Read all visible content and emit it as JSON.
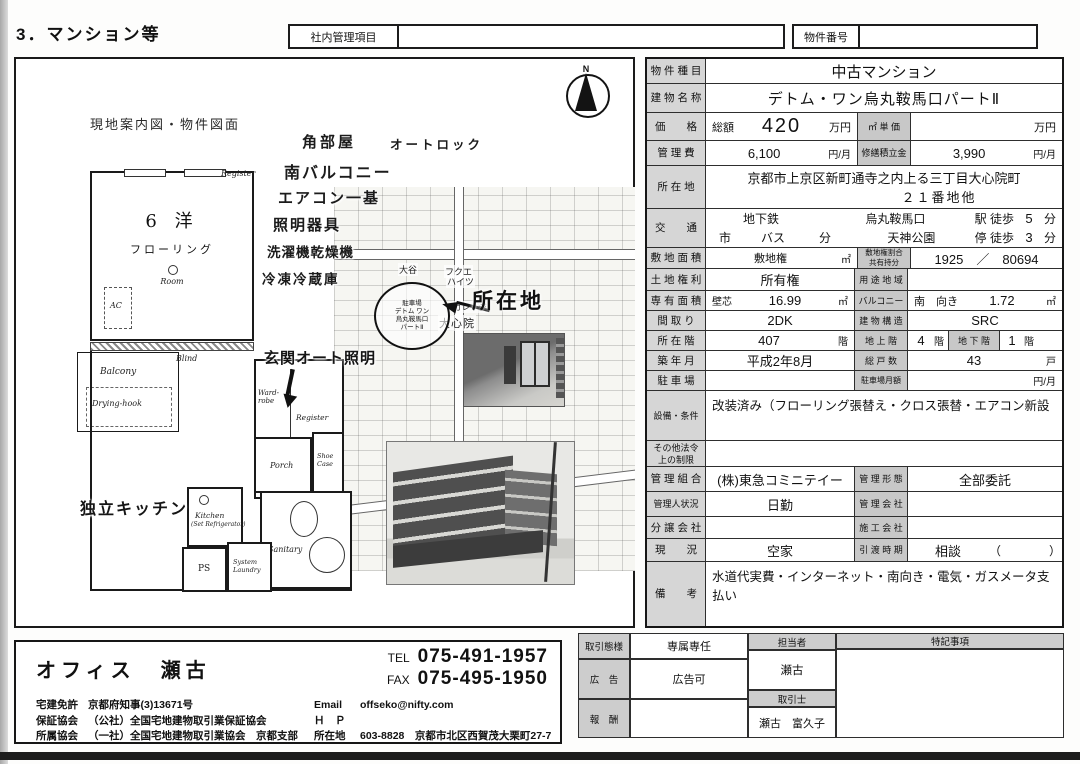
{
  "page": {
    "title": "3．マンション等"
  },
  "top_bar": {
    "internal_label": "社内管理項目",
    "internal_value": "",
    "property_no_label": "物件番号",
    "property_no_value": ""
  },
  "left_panel": {
    "caption": "現地案内図・物件図面",
    "compass_n": "N",
    "features": [
      "角部屋",
      "オートロック",
      "南バルコニー",
      "エアコン一基",
      "照明器具",
      "洗濯機乾燥機",
      "冷凍冷蔵庫"
    ],
    "floorplan": {
      "room_name": "6 洋",
      "room_floor": "フローリング",
      "room_en": "Room",
      "register_top": "Register",
      "ac": "AC",
      "blind": "Blind",
      "balcony": "Balcony",
      "drying_hook": "Drying-hook",
      "wardrobe": "Ward-robe",
      "looking_glass": "Looking-glass",
      "register_entrance": "Register",
      "porch": "Porch",
      "shoe_case": "Shoe Case",
      "kitchen": "Kitchen",
      "kitchen_sub": "(Set Refrigerator)",
      "ps": "PS",
      "laundry": "System Laundry",
      "sanitary": "Sanitary",
      "note_entrance": "玄関オート照明",
      "note_kitchen": "独立キッチン"
    },
    "map": {
      "big_label": "所在地",
      "circle_line1": "デトム ワン",
      "circle_line2": "烏丸鞍馬口",
      "circle_line3": "パートⅡ",
      "label_otani": "大谷",
      "label_fukue1": "フクエ",
      "label_fukue2": "ハイツ",
      "label_garage": "ガレージ",
      "label_daishinin": "大心院",
      "label_parking": "駐車場"
    }
  },
  "property": {
    "type_label": "物 件 種 目",
    "type": "中古マンション",
    "name_label": "建 物 名 称",
    "name": "デトム・ワン烏丸鞍馬口パートⅡ",
    "price_label": "価　　格",
    "price_total_label": "総額",
    "price": "420",
    "price_unit": "万円",
    "price_sqm_label": "㎡ 単 価",
    "price_sqm": "",
    "price_sqm_unit": "万円",
    "fee_label": "管 理 費",
    "fee": "6,100",
    "fee_unit": "円/月",
    "repair_label": "修繕積立金",
    "repair": "3,990",
    "repair_unit": "円/月",
    "addr_label": "所 在 地",
    "addr1": "京都市上京区新町通寺之内上る三丁目大心院町",
    "addr2": "２１番地他",
    "access_label": "交　　通",
    "access1_mode": "地下鉄",
    "access1_station": "烏丸鞍馬口",
    "access1_walk": "駅 徒歩",
    "access1_min": "5",
    "access1_unit": "分",
    "access2_city": "市",
    "access2_bus": "バス",
    "access2_fun": "分",
    "access2_stop_name": "天神公園",
    "access2_walk": "停 徒歩",
    "access2_min": "3",
    "access2_unit": "分",
    "site_label": "敷 地 面 積",
    "site_kind": "敷地権",
    "site_unit": "㎡",
    "site_ratio_label1": "敷地権割合",
    "site_ratio_label2": "共有持分",
    "site_ratio": "1925　／　80694",
    "land_label": "土 地 権 利",
    "land": "所有権",
    "youto_label": "用 途 地 域",
    "youto": "",
    "area_label": "専 有 面 積",
    "area_kind": "壁芯",
    "area": "16.99",
    "area_unit": "㎡",
    "balcony_label": "バルコニー",
    "balcony_dir": "南　向き",
    "balcony": "1.72",
    "balcony_unit": "㎡",
    "plan_label": "間 取 り",
    "plan": "2DK",
    "structure_label": "建 物 構 造",
    "structure": "SRC",
    "floor_label": "所 在 階",
    "floor": "407",
    "floor_unit": "階",
    "above_label": "地 上 階",
    "above": "4",
    "above_unit": "階",
    "below_label": "地 下 階",
    "below": "1",
    "below_unit": "階",
    "built_label": "築 年 月",
    "built": "平成2年8月",
    "units_label": "総 戸 数",
    "units": "43",
    "units_unit": "戸",
    "parking_label": "駐 車 場",
    "parking": "",
    "parking_fee_label": "駐車場月額",
    "parking_fee": "",
    "parking_fee_unit": "円/月",
    "equip_label": "設備・条件",
    "equip": "改装済み（フローリング張替え・クロス張替・エアコン新設",
    "law_label1": "その他法令",
    "law_label2": "上の制限",
    "law": "",
    "union_label": "管 理 組 合",
    "union": "(株)東急コミニテイー",
    "mgmt_form_label": "管 理 形 態",
    "mgmt_form": "全部委託",
    "manager_label": "管理人状況",
    "manager": "日勤",
    "mgmt_co_label": "管 理 会 社",
    "mgmt_co": "",
    "seller_label": "分 譲 会 社",
    "seller": "",
    "builder_label": "施 工 会 社",
    "builder": "",
    "status_label": "現　　況",
    "status": "空家",
    "handover_label": "引 渡 時 期",
    "handover": "相談",
    "handover_paren": "（　　　　）",
    "note_label": "備　　考",
    "note": "水道代実費・インターネット・南向き・電気・ガスメータ支払い"
  },
  "footer": {
    "office_name": "オフィス　瀬古",
    "tel_label": "TEL",
    "tel": "075-491-1957",
    "fax_label": "FAX",
    "fax": "075-495-1950",
    "license_label": "宅建免許",
    "license": "京都府知事(3)13671号",
    "guarantee_label": "保証協会",
    "guarantee": "（公社）全国宅地建物取引業保証協会",
    "assoc_label": "所属協会",
    "assoc": "（一社）全国宅地建物取引業協会　京都支部",
    "email_label": "Email",
    "email": "offseko@nifty.com",
    "hp_label": "Ｈ　Ｐ",
    "hp": "",
    "office_addr_label": "所在地",
    "office_addr": "603-8828　京都市北区西賀茂大栗町27-7",
    "deal_label": "取引態様",
    "deal": "専属専任",
    "ad_label": "広　告",
    "ad": "広告可",
    "reward_label": "報　酬",
    "reward": "",
    "staff_label": "担当者",
    "staff": "瀬古",
    "agent_label": "取引士",
    "agent": "瀬古　富久子",
    "remarks_label": "特記事項",
    "remarks": ""
  }
}
